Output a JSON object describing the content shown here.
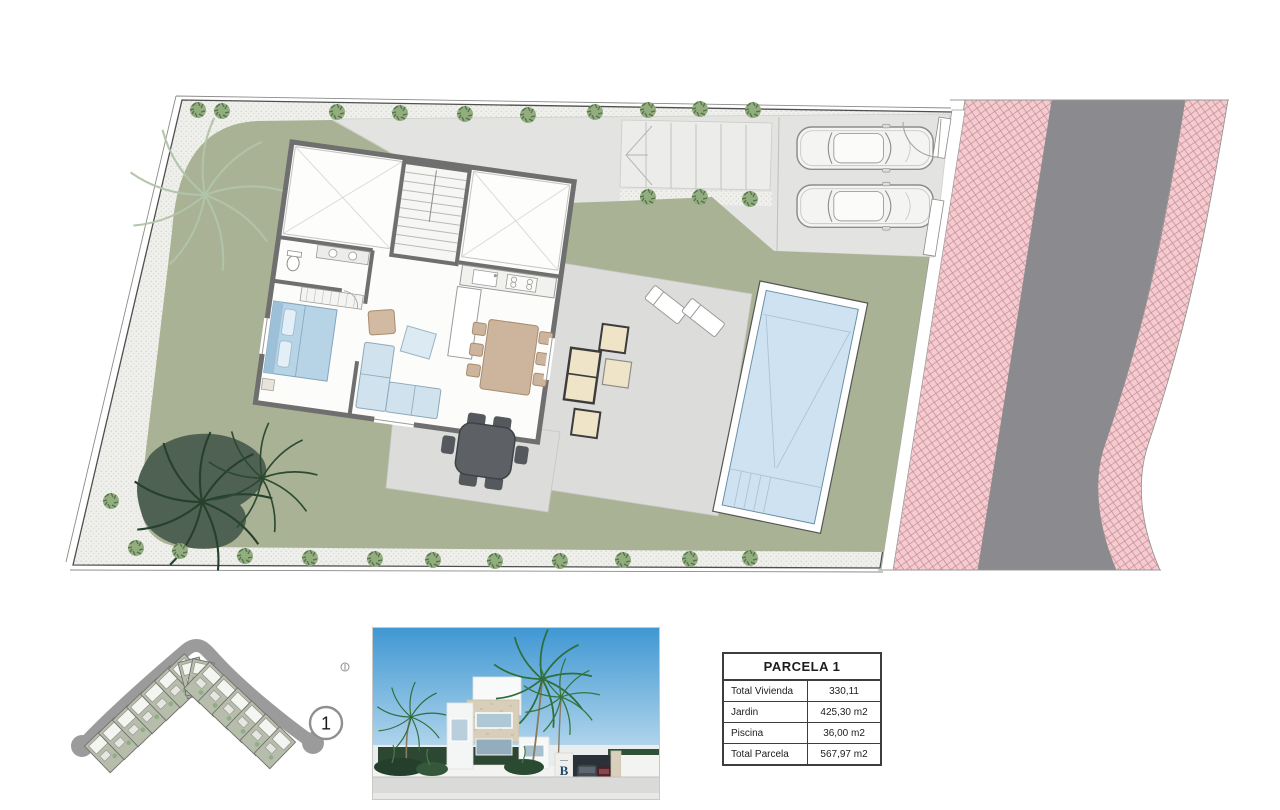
{
  "table": {
    "title": "PARCELA 1",
    "rows": [
      {
        "label": "Total Vivienda",
        "value": "330,11"
      },
      {
        "label": "Jardin",
        "value": "425,30 m2"
      },
      {
        "label": "Piscina",
        "value": "36,00 m2"
      },
      {
        "label": "Total Parcela",
        "value": "567,97 m2"
      }
    ]
  },
  "mini_plan": {
    "plot_marker_label": "1"
  },
  "villa_photo": {
    "gate_logo": "B"
  },
  "colors": {
    "garden_green": "#a9b294",
    "dark_foliage": "#4e6152",
    "terrace_gray": "#dcdcdb",
    "driveway_gray": "#e3e3e1",
    "road_gray": "#8b8b8f",
    "sidewalk_pink": "#f3ccd1",
    "pool_water": "#cfe2f2",
    "wall_gray": "#6f6f6f",
    "sky_blue": "#4b9fd8"
  }
}
